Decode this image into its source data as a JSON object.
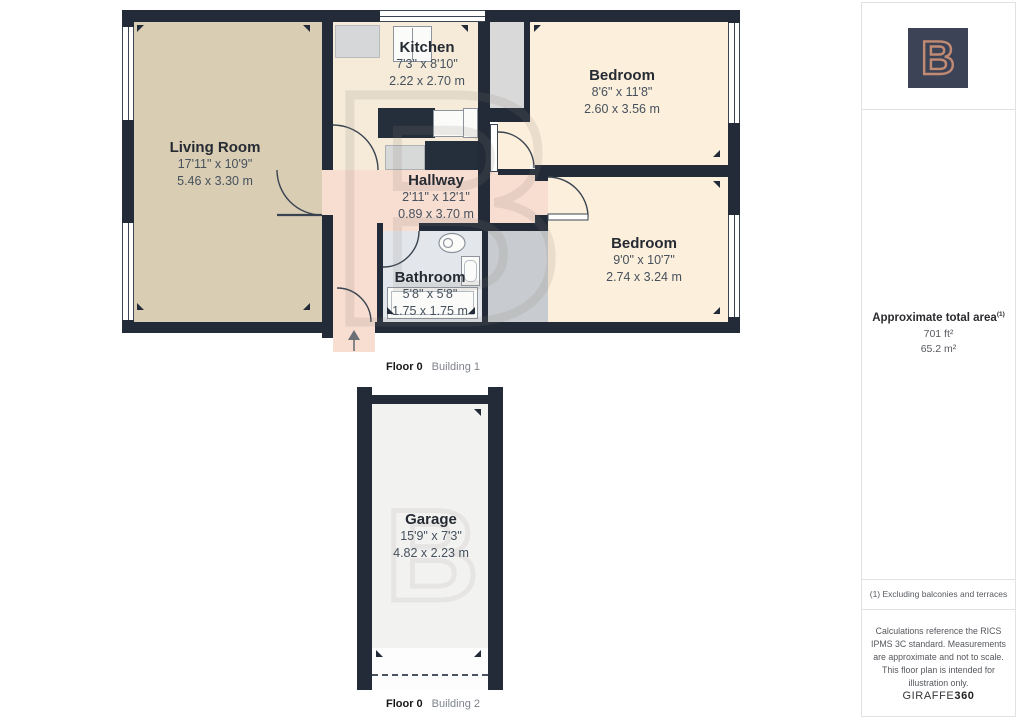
{
  "buildings": [
    {
      "caption_floor": "Floor 0",
      "caption_building": "Building 1",
      "rooms": [
        {
          "name": "Living Room",
          "imperial": "17'11\" x 10'9\"",
          "metric": "5.46 x 3.30 m"
        },
        {
          "name": "Kitchen",
          "imperial": "7'3\" x 8'10\"",
          "metric": "2.22 x 2.70 m"
        },
        {
          "name": "Hallway",
          "imperial": "2'11\" x 12'1\"",
          "metric": "0.89 x 3.70 m"
        },
        {
          "name": "Bathroom",
          "imperial": "5'8\" x 5'8\"",
          "metric": "1.75 x 1.75 m"
        },
        {
          "name": "Bedroom",
          "imperial": "8'6\" x 11'8\"",
          "metric": "2.60 x 3.56 m"
        },
        {
          "name": "Bedroom",
          "imperial": "9'0\" x 10'7\"",
          "metric": "2.74 x 3.24 m"
        }
      ]
    },
    {
      "caption_floor": "Floor 0",
      "caption_building": "Building 2",
      "rooms": [
        {
          "name": "Garage",
          "imperial": "15'9\" x 7'3\"",
          "metric": "4.82 x 2.23 m"
        }
      ]
    }
  ],
  "sidebar": {
    "logo_letter": "B",
    "area_title": "Approximate total area",
    "area_footnote_ref": "(1)",
    "area_imperial": "701 ft²",
    "area_metric": "65.2 m²",
    "footnote": "(1) Excluding balconies and terraces",
    "disclaimer": "Calculations reference the RICS IPMS 3C standard. Measurements are approximate and not to scale. This floor plan is intended for illustration only.",
    "brand_name": "GIRAFFE",
    "brand_suffix": "360"
  },
  "watermark_letter": "B",
  "colors": {
    "wall": "#222b37",
    "living": "#d9cdb4",
    "kitchen": "#f5ebd8",
    "bedroom": "#fcefdc",
    "hallway": "#f8ddd1",
    "bathroom": "#e3e7ec",
    "closet": "#c8cbcf",
    "garage": "#f2f2f1",
    "logo_bg": "#3d4357",
    "logo_accent": "#c18a73"
  }
}
